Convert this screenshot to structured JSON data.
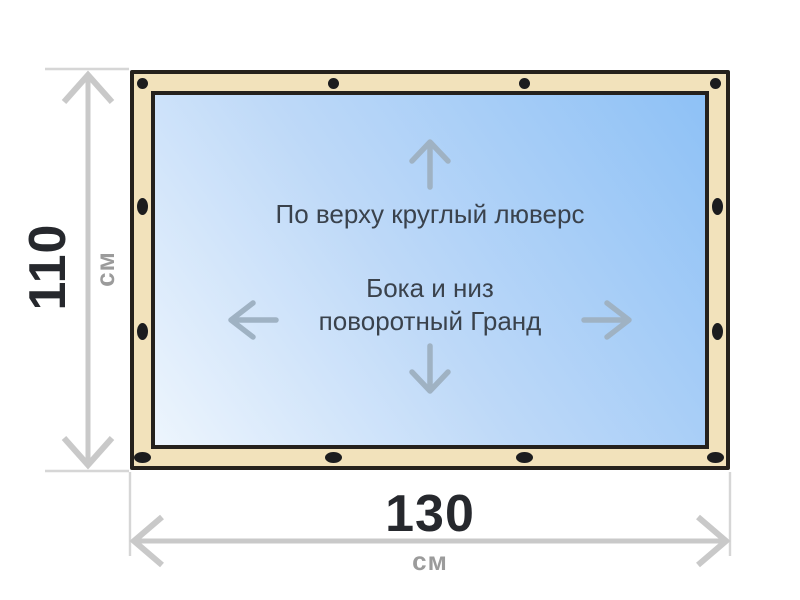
{
  "product": {
    "type_note_top": "По верху круглый люверс",
    "type_note_sides_line1": "Бока и низ",
    "type_note_sides_line2": "поворотный Гранд"
  },
  "dimensions": {
    "height": {
      "value": "110",
      "unit": "см"
    },
    "width": {
      "value": "130",
      "unit": "см"
    }
  },
  "icons": {
    "top_edge": "arrow-up-icon",
    "left_edge": "arrow-left-icon",
    "right_edge": "arrow-right-icon",
    "bottom_edge": "arrow-down-icon",
    "fasteners_top": "round-grommet-dots",
    "fasteners_sides_bottom": "oval-grommet-dots"
  },
  "colors": {
    "frame_fill": "#f2e2bb",
    "frame_outline": "#25211c",
    "canvas_gradient_light": "#edf5fd",
    "canvas_gradient_mid": "#bed9f8",
    "canvas_gradient_deep": "#8ec1f6",
    "grommet": "#1c1c1e",
    "dimension_line": "#c9c9c9",
    "extension_line": "#d6d6d6",
    "dimension_number": "#26282d",
    "dimension_unit": "#9b9b9b",
    "note_text": "#3a424c",
    "direction_arrow": "#9fb2c3"
  }
}
